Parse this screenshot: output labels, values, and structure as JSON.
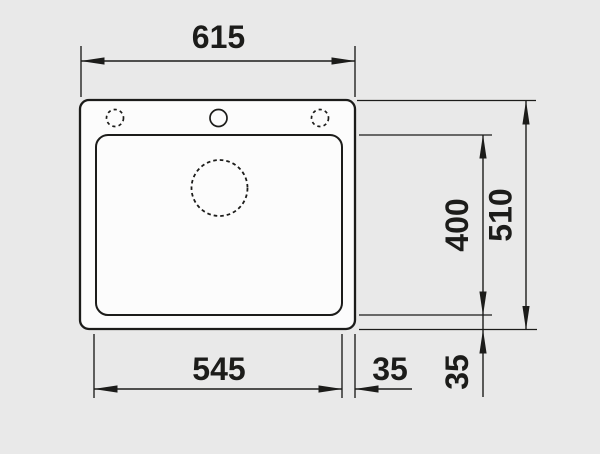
{
  "colors": {
    "background": "#e9e9e9",
    "line": "#1c1c1a",
    "sink_fill": "#fcfcfc"
  },
  "dimensions": {
    "overall_width": "615",
    "overall_height": "510",
    "bowl_height": "400",
    "bowl_width": "545",
    "right_edge_gap": "35",
    "bottom_edge_gap": "35"
  },
  "features": {
    "tap_hole_left_style": "dashed",
    "tap_hole_center_style": "solid",
    "tap_hole_right_style": "dashed",
    "drain_style": "dashed"
  }
}
